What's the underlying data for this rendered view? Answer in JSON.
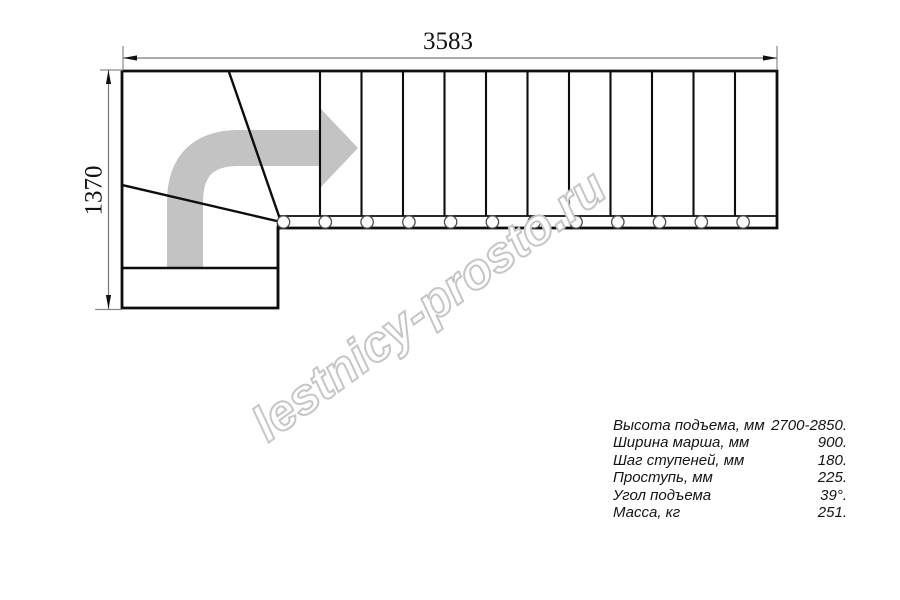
{
  "page": {
    "background": "#ffffff"
  },
  "drawing": {
    "top_dimension": "3583",
    "left_dimension": "1370",
    "watermark": "lestnicy-prosto.ru",
    "colors": {
      "arrow": "#c3c3c3",
      "watermark_outline": "#c6c6c6",
      "watermark_fill": "#ffffff",
      "line": "#0d0d0d",
      "dimension_line": "#777777"
    }
  },
  "specs": {
    "rows": [
      {
        "label": "Высота подъема, мм",
        "value": "2700-2850."
      },
      {
        "label": "Ширина марша, мм",
        "value": "900."
      },
      {
        "label": "Шаг ступеней, мм",
        "value": "180."
      },
      {
        "label": "Проступь, мм",
        "value": "225."
      },
      {
        "label": "Угол подъема",
        "value": "39°."
      },
      {
        "label": "Масса, кг",
        "value": "251."
      }
    ]
  }
}
